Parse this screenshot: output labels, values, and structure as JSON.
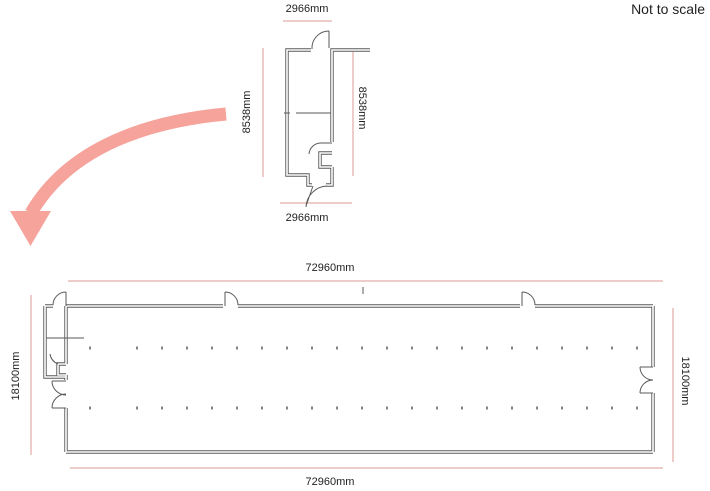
{
  "page": {
    "note": "Not to scale"
  },
  "colors": {
    "background": "#ffffff",
    "wall": "#5a5a5a",
    "dimension_line": "#dc9a94",
    "arrow": "#f6a39b",
    "text": "#1f1f1f"
  },
  "detail_plan": {
    "title": "entrance-room-detail-plan",
    "dimensions": {
      "top": "2966mm",
      "bottom": "2966mm",
      "left": "8538mm",
      "right": "8538mm"
    }
  },
  "overall_plan": {
    "title": "building-overall-floor-plan",
    "dimensions": {
      "top": "72960mm",
      "bottom": "72960mm",
      "left": "18100mm",
      "right": "18100mm"
    }
  }
}
